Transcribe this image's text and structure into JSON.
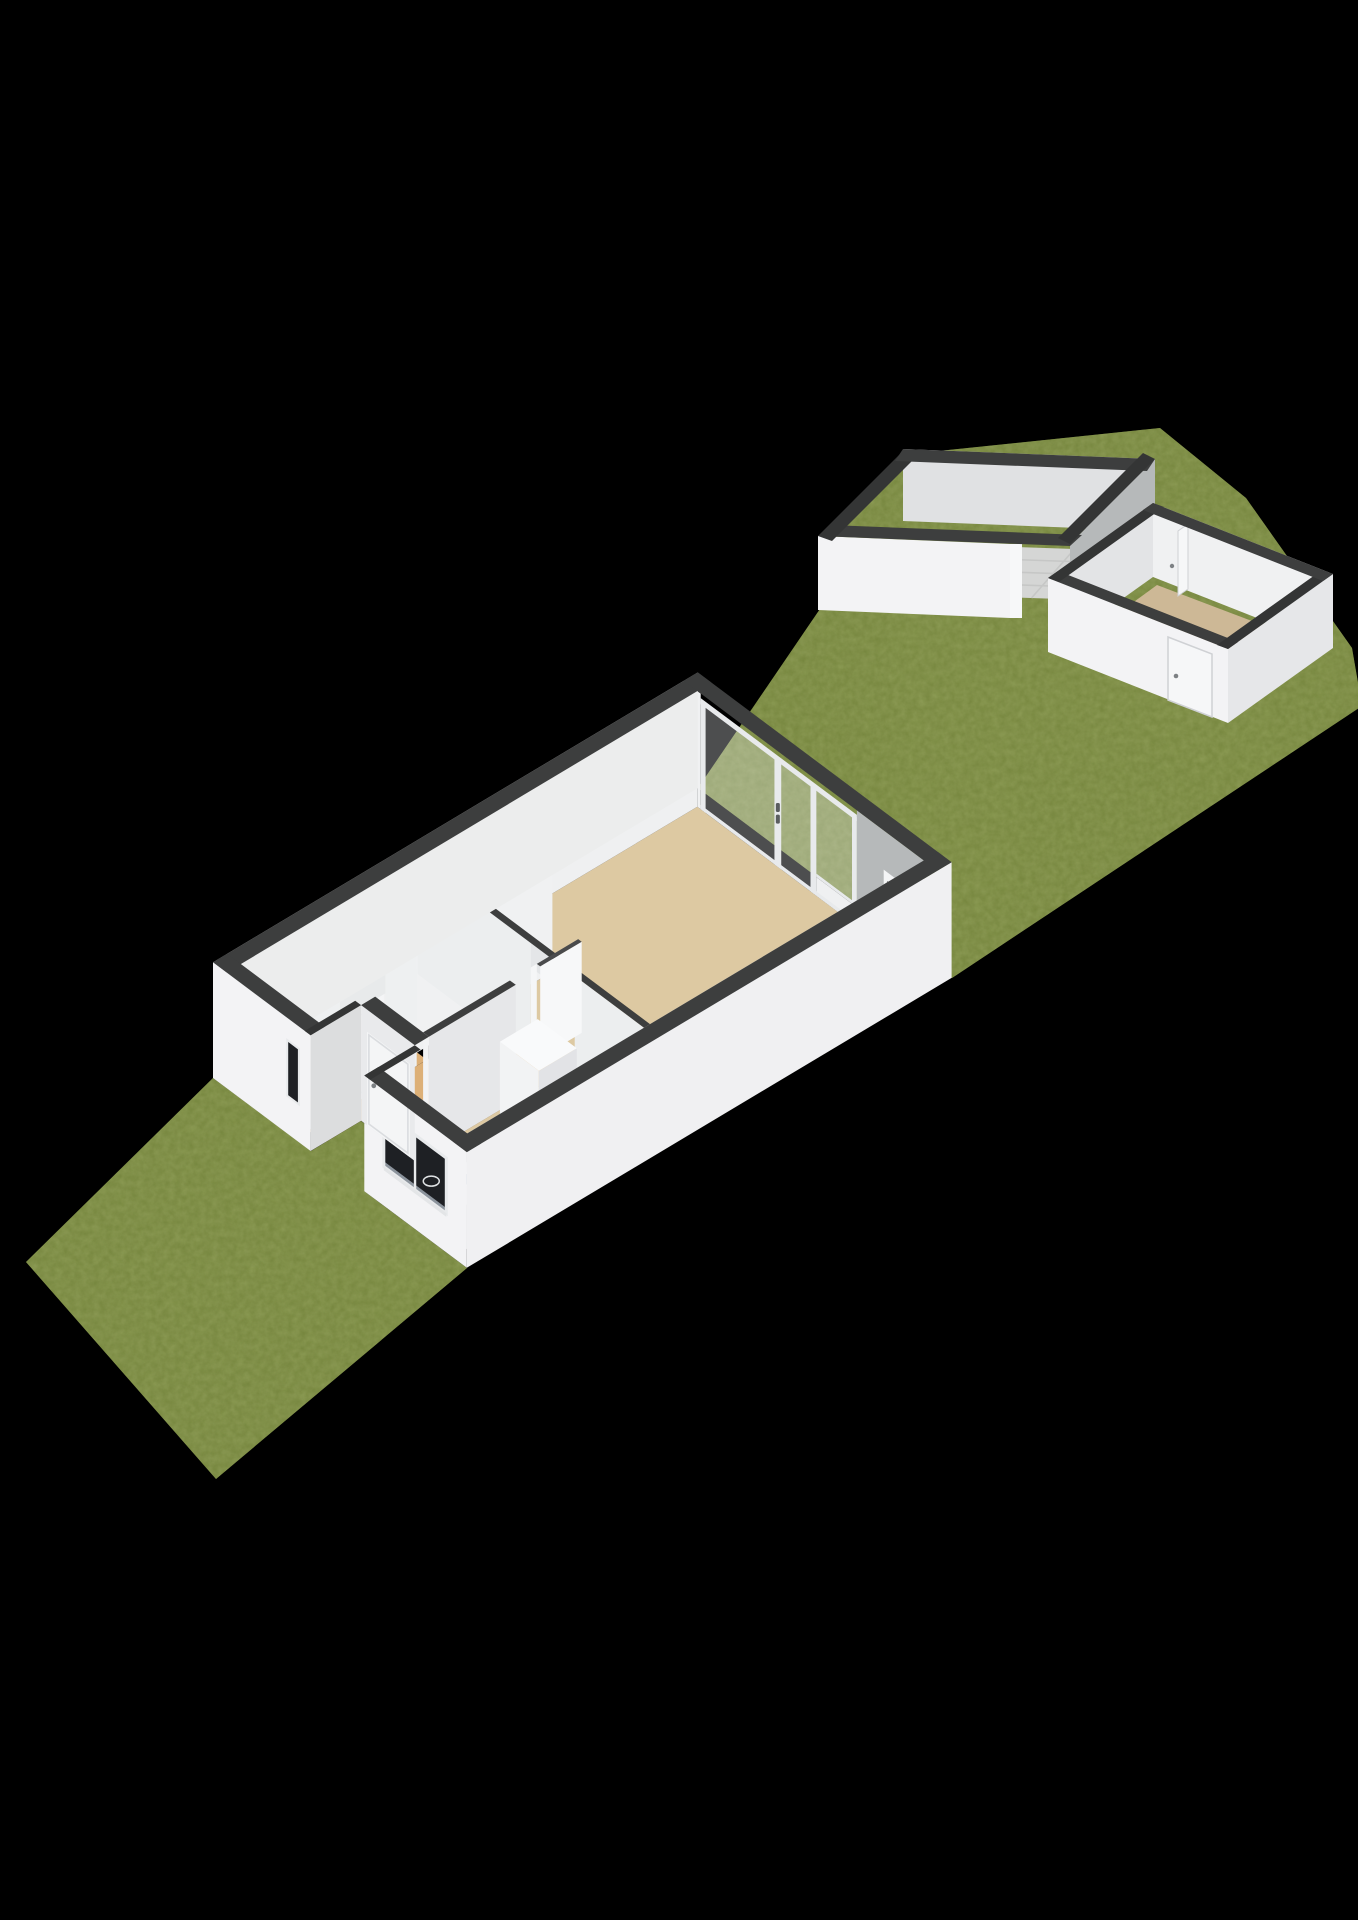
{
  "view": {
    "kind": "3d-floorplan-isometric-render",
    "width": 1358,
    "height": 1920,
    "background": "#000000"
  },
  "palette": {
    "black": "#000000",
    "grass": "#7e8f45",
    "grass_speck_dark": "#4c5c22",
    "grass_speck_light": "#9aa85e",
    "wall_cap": "#3d3e3e",
    "wall_cap_dark": "#343535",
    "wall_bright": "#f3f3f5",
    "wall_light": "#eceded",
    "wall_mid": "#e6e7e9",
    "wall_soft": "#dcddde",
    "wall_shadow": "#c9cbcd",
    "wall_inner_gray": "#b6b9ba",
    "floor_living": "#ddc9a2",
    "floor_hall": "#ddb077",
    "floor_wc": "#e9e9ea",
    "floor_shed": "#d5d6d5",
    "floor_shed_small": "#cdb896",
    "tile_line": "#c6c7c6",
    "counter_dark": "#1d1e20",
    "counter_dark_top": "#232426",
    "counter_blue": "#c7d2de",
    "counter_blue_deep": "#aebacA",
    "stair_top": "#f6f6f8",
    "stair_riser": "#e4e5e7",
    "frame_white": "#e8eaec",
    "frame_gray": "#cfd1d4",
    "opening_dark": "#1e2024",
    "glass_tint": "rgba(240,244,246,0.32)",
    "handle_gray": "#7d8184",
    "fixture_white": "#fbfbfc"
  },
  "scene": {
    "areas": [
      {
        "name": "front-garden",
        "kind": "grass-lawn"
      },
      {
        "name": "back-garden",
        "kind": "grass-lawn"
      },
      {
        "name": "living-room",
        "kind": "room-beige-floor"
      },
      {
        "name": "kitchen",
        "kind": "room-with-counters"
      },
      {
        "name": "hallway",
        "kind": "room-tan-floor"
      },
      {
        "name": "wc",
        "kind": "small-room-with-toilet"
      },
      {
        "name": "staircase",
        "kind": "stairs-9-treads"
      },
      {
        "name": "porch-recess",
        "kind": "entrance-nook"
      },
      {
        "name": "shed-large",
        "kind": "outbuilding-tiled-floor"
      },
      {
        "name": "shed-small",
        "kind": "outbuilding-with-door"
      }
    ],
    "features": [
      {
        "name": "patio-sliding-window",
        "on": "living-room-back-wall"
      },
      {
        "name": "wall-vent",
        "on": "living-room-back-wall"
      },
      {
        "name": "kitchen-window",
        "on": "front-wall"
      },
      {
        "name": "sidelight-window",
        "on": "front-wall"
      },
      {
        "name": "front-door",
        "on": "porch-recess"
      },
      {
        "name": "wc-door",
        "on": "wc-wall"
      },
      {
        "name": "living-room-door",
        "on": "hall-living-wall"
      },
      {
        "name": "gas-hob",
        "on": "dark-counter"
      },
      {
        "name": "sink",
        "on": "blue-counter"
      },
      {
        "name": "tall-cabinet",
        "on": "kitchen"
      },
      {
        "name": "toilet",
        "on": "wc"
      },
      {
        "name": "shed-door",
        "on": "shed-small"
      }
    ]
  }
}
